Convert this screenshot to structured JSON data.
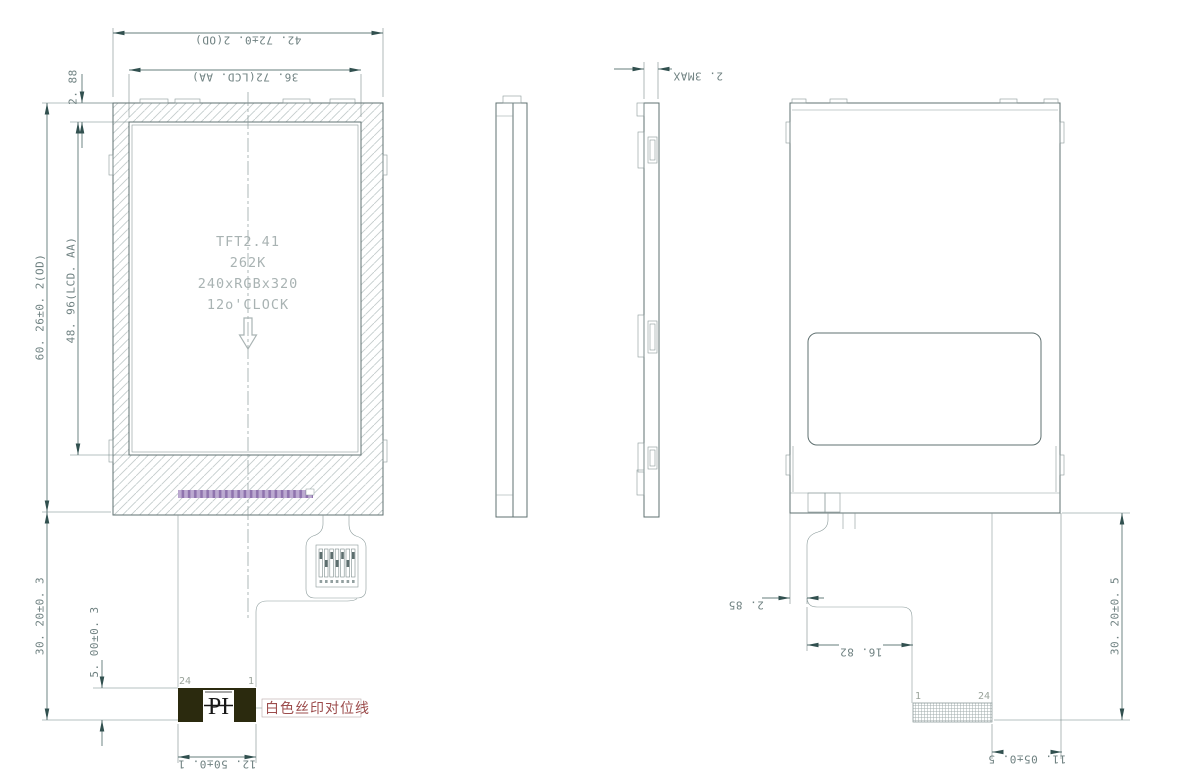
{
  "front_view": {
    "panel_label": [
      "TFT2.41",
      "262K",
      "240xRGBx320",
      "12o'CLOCK"
    ],
    "dim_od_width": "42. 72±0. 2(OD)",
    "dim_aa_width": "36. 72(LCD. AA)",
    "dim_top_margin": "2. 88",
    "dim_od_height": "60. 26±0. 2(OD)",
    "dim_aa_height": "48. 96(LCD. AA)",
    "dim_fpc_drop": "30. 20±0. 3",
    "dim_pi_height": "5. 00±0. 3",
    "dim_connector_width": "12. 50±0. 1",
    "pin_first": "24",
    "pin_last": "1",
    "alignment_mark": "PI",
    "silkscreen_note": "白色丝印对位线"
  },
  "side_view": {
    "dim_thickness": "2. 3MAX"
  },
  "back_view": {
    "dim_fpc_offset": "2. 85",
    "dim_fpc_step": "16. 82",
    "dim_fpc_drop": "30. 20±0. 5",
    "dim_connector_offset": "11. 05±0. 5",
    "pin_last": "1",
    "pin_first": "24"
  },
  "colors": {
    "outline": "#5f7070",
    "hatch": "#c3cccc",
    "dimension": "#31504f",
    "dimension_text": "#6f8181",
    "label_text": "#a9b3b3",
    "driver_strip": "#bcaad1",
    "driver_strip_tick": "#8f74ae",
    "connector_block": "#2b2a0e",
    "note_red": "#9c4c4c"
  }
}
